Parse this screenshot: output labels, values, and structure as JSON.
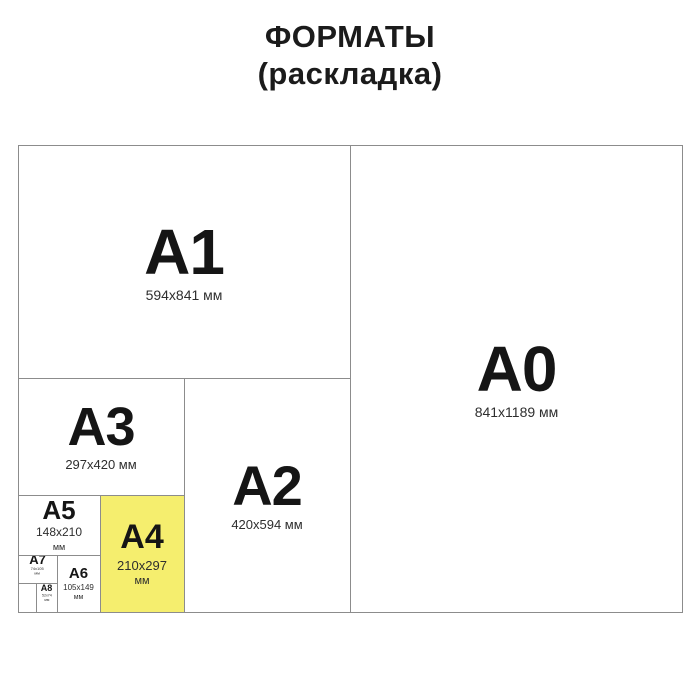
{
  "title": {
    "line1": "ФОРМАТЫ",
    "line2": "(раскладка)"
  },
  "colors": {
    "highlight_fill": "#f5ee6e",
    "line": "#8c8c8c",
    "text": "#141414",
    "background": "#ffffff"
  },
  "highlighted_format": "A4",
  "formats": {
    "a0": {
      "name": "A0",
      "size": "841x1189 мм"
    },
    "a1": {
      "name": "A1",
      "size": "594x841 мм"
    },
    "a2": {
      "name": "A2",
      "size": "420x594 мм"
    },
    "a3": {
      "name": "A3",
      "size": "297x420 мм"
    },
    "a4": {
      "name": "A4",
      "size": "210x297",
      "unit": "мм"
    },
    "a5": {
      "name": "A5",
      "size": "148x210",
      "unit": "мм"
    },
    "a6": {
      "name": "A6",
      "size": "105x149",
      "unit": "мм"
    },
    "a7": {
      "name": "A7",
      "size": "74x105",
      "unit": "мм"
    },
    "a8": {
      "name": "A8",
      "size": "52x74",
      "unit": "мм"
    }
  }
}
